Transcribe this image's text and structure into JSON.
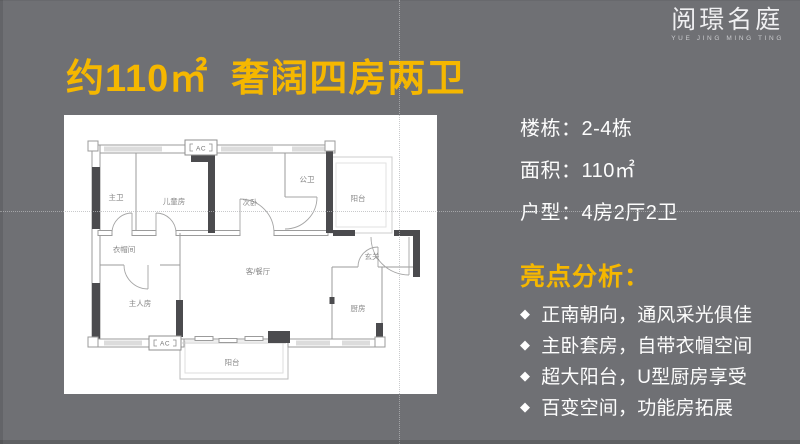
{
  "slide": {
    "background_color": "#6f7074",
    "accent_color": "#f5b700"
  },
  "logo": {
    "name": "阅璟名庭",
    "subtitle": "YUE JING MING TING"
  },
  "title": "约110㎡  奢阔四房两卫",
  "info": {
    "rows": [
      {
        "label": "楼栋：",
        "value": "2-4栋"
      },
      {
        "label": "面积：",
        "value": "110㎡"
      },
      {
        "label": "户型：",
        "value": "4房2厅2卫"
      }
    ],
    "highlights_title": "亮点分析：",
    "bullet_icon": "◆",
    "highlights": [
      "正南朝向，通风采光俱佳",
      "主卧套房，自带衣帽空间",
      "超大阳台，U型厨房享受",
      "百变空间，功能房拓展"
    ]
  },
  "floorplan": {
    "ac_label": "AC",
    "rooms": [
      {
        "name": "master-bath",
        "label": "主卫"
      },
      {
        "name": "kids-room",
        "label": "儿童房"
      },
      {
        "name": "second-bedroom",
        "label": "次卧"
      },
      {
        "name": "guest-bath",
        "label": "公卫"
      },
      {
        "name": "balcony-top",
        "label": "阳台"
      },
      {
        "name": "cloakroom",
        "label": "衣帽间"
      },
      {
        "name": "master-bedroom",
        "label": "主人房"
      },
      {
        "name": "living-dining",
        "label": "客/餐厅"
      },
      {
        "name": "foyer",
        "label": "玄关"
      },
      {
        "name": "kitchen",
        "label": "厨房"
      },
      {
        "name": "balcony-bottom",
        "label": "阳台"
      }
    ]
  }
}
